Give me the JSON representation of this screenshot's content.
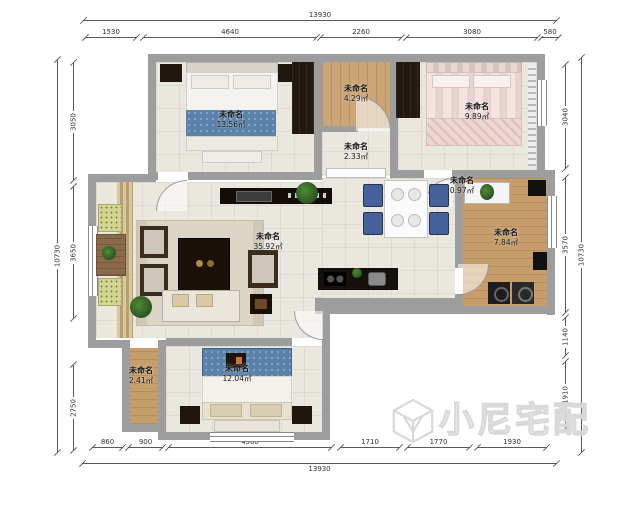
{
  "watermark": {
    "brand": "小尼宅配"
  },
  "dims": {
    "top_total": "13930",
    "top_segs": [
      "1530",
      "4640",
      "2260",
      "3080",
      "580"
    ],
    "bottom_total": "13930",
    "bottom_segs": [
      "860",
      "900",
      "4560",
      "1710",
      "1770",
      "1930"
    ],
    "left_total": "10730",
    "left_segs": [
      "3050",
      "3650",
      "2750"
    ],
    "right_total": "10730",
    "right_segs": [
      "3040",
      "3570",
      "1140",
      "1910"
    ]
  },
  "rooms": {
    "tl_bedroom": {
      "name": "未命名",
      "area": "13.56㎡"
    },
    "top_small": {
      "name": "未命名",
      "area": "4.29㎡"
    },
    "hallway": {
      "name": "未命名",
      "area": "2.33㎡"
    },
    "tr_bedroom": {
      "name": "未命名",
      "area": "9.89㎡"
    },
    "living": {
      "name": "未命名",
      "area": "35.92㎡"
    },
    "entry": {
      "name": "未命名",
      "area": "0.97㎡"
    },
    "right_room": {
      "name": "未命名",
      "area": "7.84㎡"
    },
    "bl_room": {
      "name": "未命名",
      "area": "2.41㎡"
    },
    "bottom_bedroom": {
      "name": "未命名",
      "area": "12.04㎡"
    }
  }
}
